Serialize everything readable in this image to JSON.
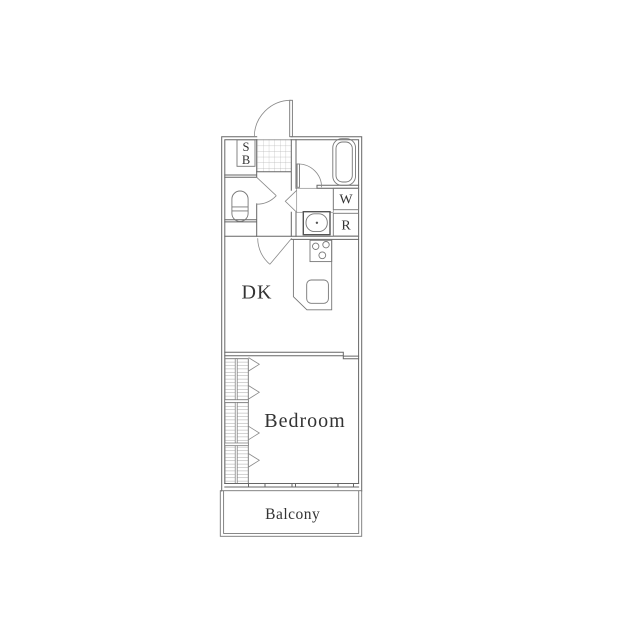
{
  "floorplan": {
    "type": "apartment-floor-plan",
    "rooms": {
      "dining_kitchen": {
        "label": "DK"
      },
      "bedroom": {
        "label": "Bedroom"
      },
      "balcony": {
        "label": "Balcony"
      }
    },
    "fixtures": {
      "shoe_box": {
        "label_line1": "S",
        "label_line2": "B"
      },
      "washing_machine": {
        "label": "W"
      },
      "refrigerator": {
        "label": "R"
      }
    },
    "colors": {
      "background": "#ffffff",
      "wall_line": "#666666",
      "fixture_line": "#777777",
      "floor_pattern": "#b3b3b3",
      "label_text": "#333333"
    }
  }
}
